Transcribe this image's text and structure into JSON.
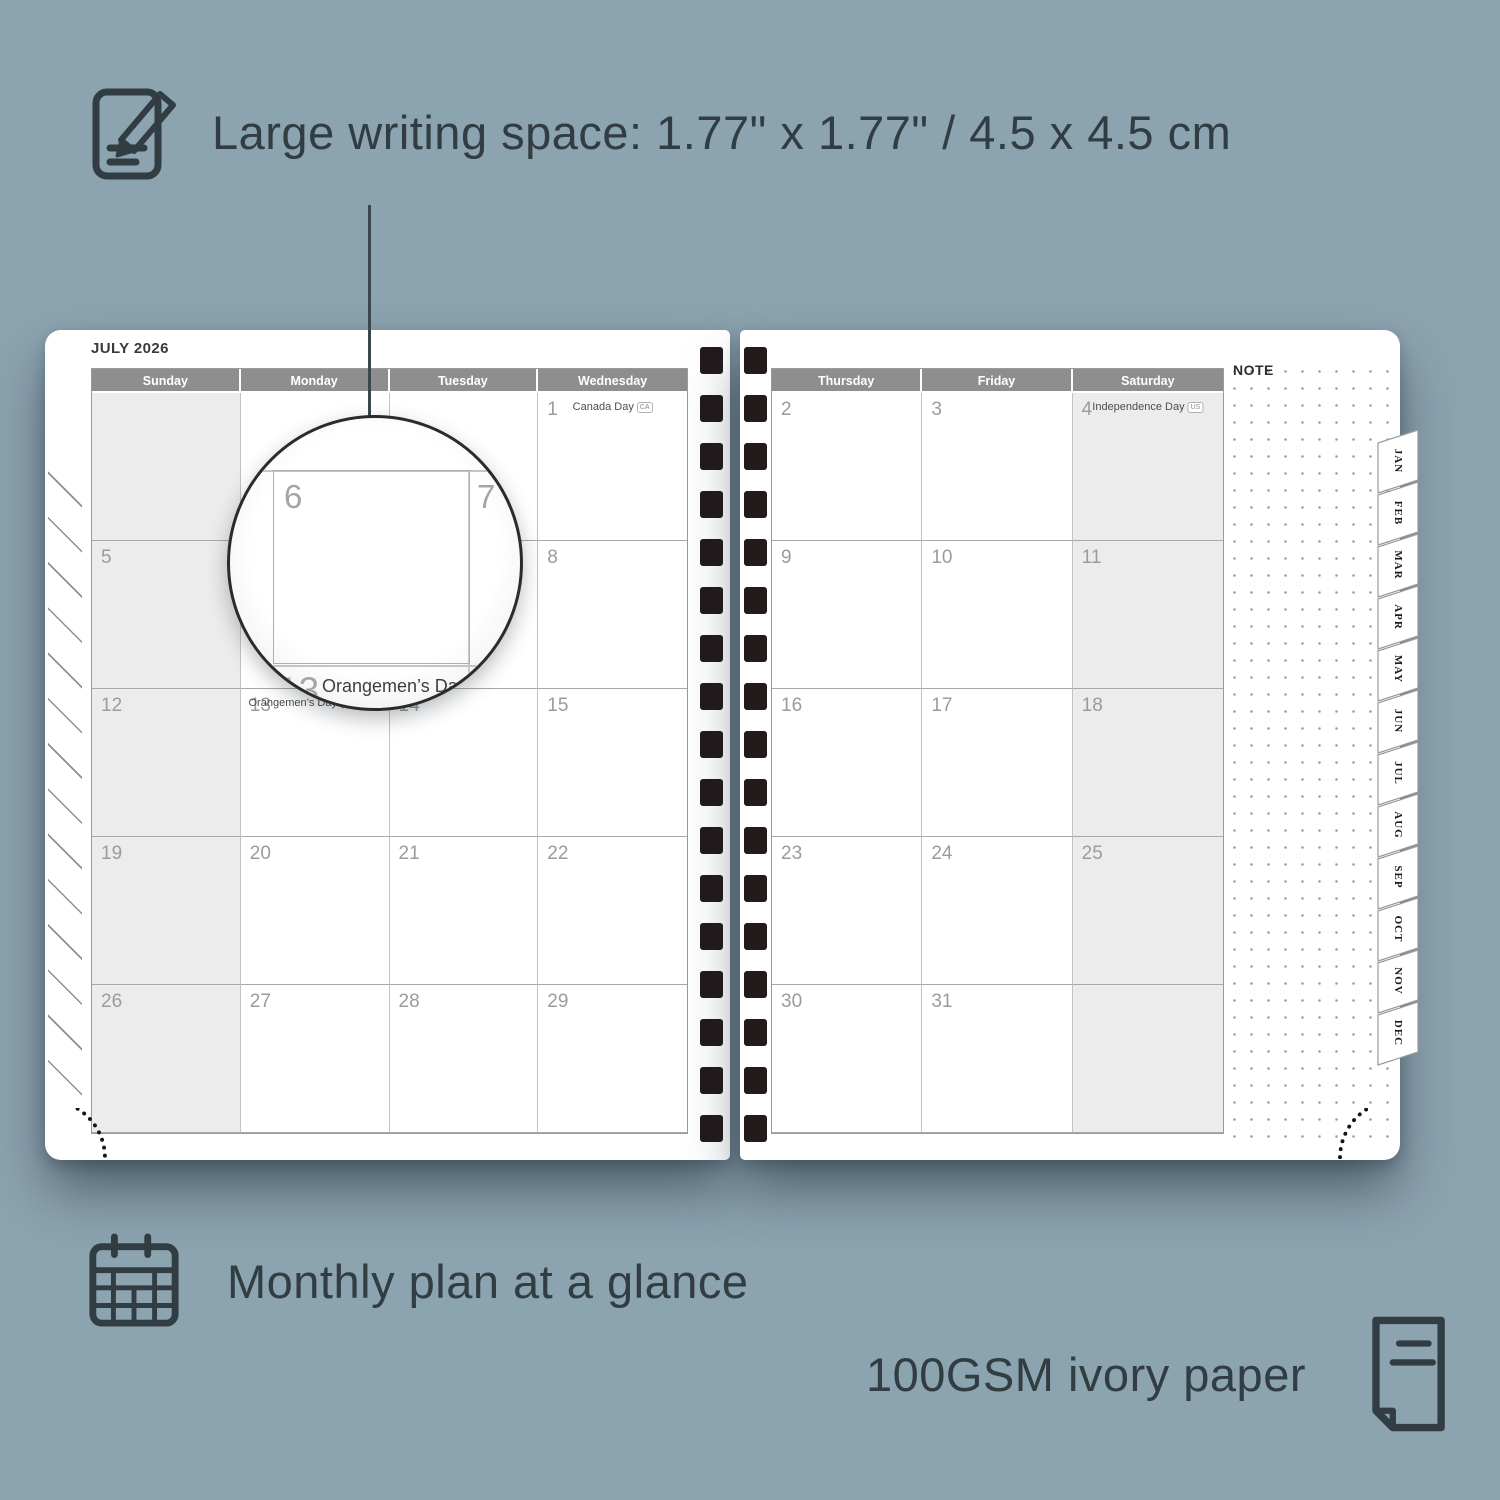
{
  "annotations": {
    "writing_space": {
      "icon": "notepad-pencil-icon",
      "label": "Large writing space: 1.77\" x 1.77\" / 4.5 x 4.5 cm"
    },
    "monthly_plan": {
      "icon": "calendar-grid-icon",
      "label": "Monthly plan at a glance"
    },
    "paper": {
      "icon": "paper-icon",
      "label": "100GSM ivory paper"
    }
  },
  "planner": {
    "month_title": "JULY 2026",
    "note_label": "NOTE",
    "month_tabs": [
      "JAN",
      "FEB",
      "MAR",
      "APR",
      "MAY",
      "JUN",
      "JUL",
      "AUG",
      "SEP",
      "OCT",
      "NOV",
      "DEC"
    ],
    "pages": {
      "left": {
        "day_headers": [
          "Sunday",
          "Monday",
          "Tuesday",
          "Wednesday"
        ],
        "shaded_column": 0,
        "weeks": [
          [
            {
              "date": ""
            },
            {
              "date": ""
            },
            {
              "date": ""
            },
            {
              "date": "1",
              "holiday": "Canada Day",
              "badge": "CA"
            }
          ],
          [
            {
              "date": "5"
            },
            {
              "date": "6"
            },
            {
              "date": "7"
            },
            {
              "date": "8"
            }
          ],
          [
            {
              "date": "12"
            },
            {
              "date": "13",
              "holiday": "Orangemen’s Day (n.i.)",
              "badge": "UK"
            },
            {
              "date": "14"
            },
            {
              "date": "15"
            }
          ],
          [
            {
              "date": "19"
            },
            {
              "date": "20"
            },
            {
              "date": "21"
            },
            {
              "date": "22"
            }
          ],
          [
            {
              "date": "26"
            },
            {
              "date": "27"
            },
            {
              "date": "28"
            },
            {
              "date": "29"
            }
          ]
        ]
      },
      "right": {
        "day_headers": [
          "Thursday",
          "Friday",
          "Saturday"
        ],
        "shaded_column": 2,
        "weeks": [
          [
            {
              "date": "2"
            },
            {
              "date": "3"
            },
            {
              "date": "4",
              "holiday": "Independence Day",
              "badge": "US"
            }
          ],
          [
            {
              "date": "9"
            },
            {
              "date": "10"
            },
            {
              "date": "11"
            }
          ],
          [
            {
              "date": "16"
            },
            {
              "date": "17"
            },
            {
              "date": "18"
            }
          ],
          [
            {
              "date": "23"
            },
            {
              "date": "24"
            },
            {
              "date": "25"
            }
          ],
          [
            {
              "date": "30"
            },
            {
              "date": "31"
            },
            {
              "date": ""
            }
          ]
        ]
      }
    },
    "magnifier": {
      "zoom_day": "6",
      "adjacent_day": "7",
      "zoom_row_day": "13",
      "zoom_holiday": "Orangemen’s Day (n.i.)",
      "zoom_badge": "UK"
    }
  },
  "colors": {
    "background": "#8ca3b0",
    "annotation_text": "#313d43",
    "day_header_bg": "#8e8e8e",
    "day_header_text": "#ffffff",
    "shaded_cell": "#ececec",
    "page": "#ffffff",
    "date_number": "#9b9b9b",
    "holiday_text": "#4c4c4c",
    "spiral_hole": "#221a1b"
  }
}
